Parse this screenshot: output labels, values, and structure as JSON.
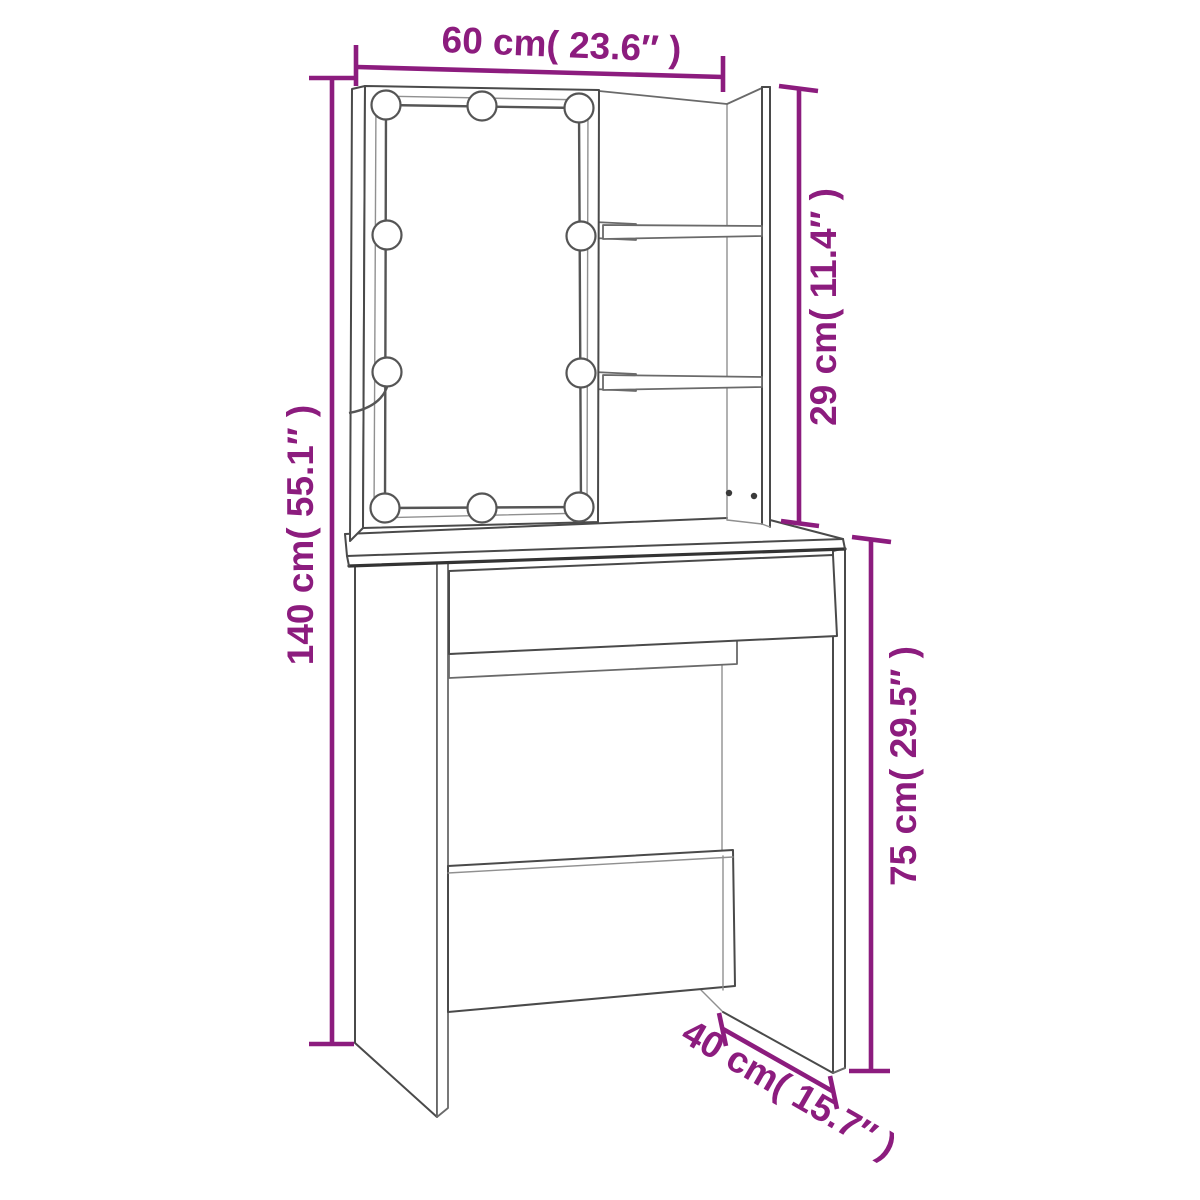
{
  "diagram": {
    "type": "furniture-dimension-diagram",
    "subject": "dressing table with LED mirror, two open shelves, drawer and open base",
    "colors": {
      "dimension_accent": "#8C1C7E",
      "outline": "#4a4a4a",
      "background": "#ffffff"
    },
    "dimensions": [
      {
        "name": "overall-width",
        "label": "60 cm( 23.6″ )",
        "value_cm": 60,
        "value_inch": 23.6,
        "placement": "top-horizontal"
      },
      {
        "name": "overall-height",
        "label": "140 cm( 55.1″ )",
        "value_cm": 140,
        "value_inch": 55.1,
        "placement": "left-vertical"
      },
      {
        "name": "upper-cabinet-height",
        "label": "29 cm( 11.4″ )",
        "value_cm": 29,
        "value_inch": 11.4,
        "placement": "right-upper-vertical"
      },
      {
        "name": "table-height",
        "label": "75 cm( 29.5″ )",
        "value_cm": 75,
        "value_inch": 29.5,
        "placement": "right-lower-vertical"
      },
      {
        "name": "depth",
        "label": "40 cm( 15.7″ )",
        "value_cm": 40,
        "value_inch": 15.7,
        "placement": "bottom-right-diagonal"
      }
    ],
    "features": {
      "led_bulbs": 10,
      "shelves": 2,
      "drawers": 1,
      "has_power_cord": true,
      "screw_marks": 2
    }
  }
}
